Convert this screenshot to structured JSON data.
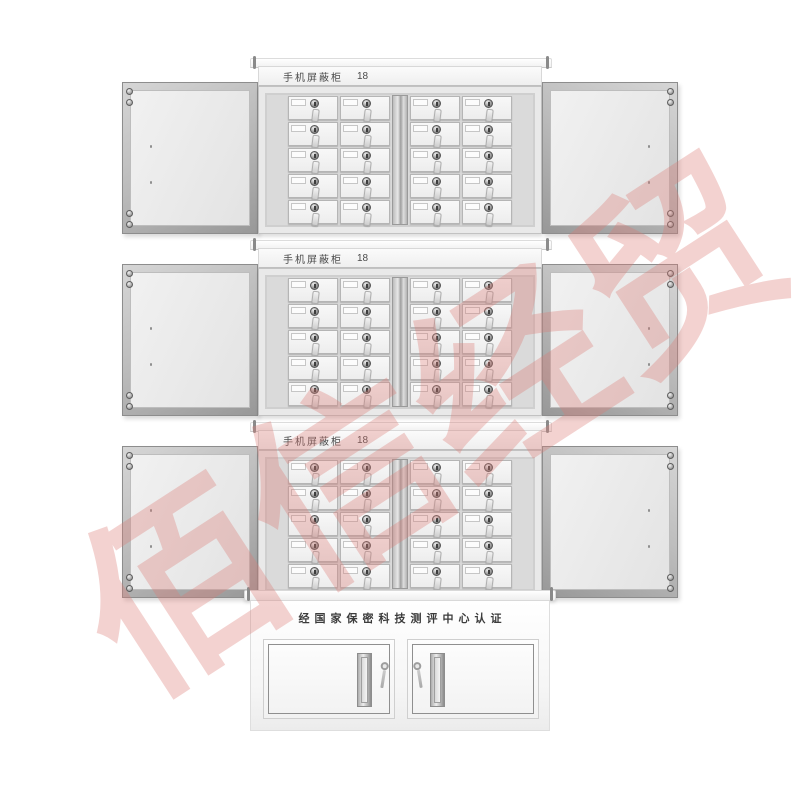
{
  "product": {
    "watermark_text": "佰信经贸"
  },
  "units": [
    {
      "label": "手机屏蔽柜",
      "number": "18"
    },
    {
      "label": "手机屏蔽柜",
      "number": "18"
    },
    {
      "label": "手机屏蔽柜",
      "number": "18"
    }
  ],
  "base": {
    "certification": "经国家保密科技测评中心认证"
  },
  "layout": {
    "unit_count": 3,
    "groups_per_unit": 2,
    "cols_per_group": 2,
    "rows_per_group": 5,
    "base_door_count": 2
  },
  "colors": {
    "background": "#FFFFFF",
    "watermark_pink": "#DD7B76",
    "cabinet_light": "#ECECEC",
    "cabinet_frame": "#A9A9A9",
    "label_text": "#4A4A4A",
    "certification_text": "#3C3C3C"
  }
}
